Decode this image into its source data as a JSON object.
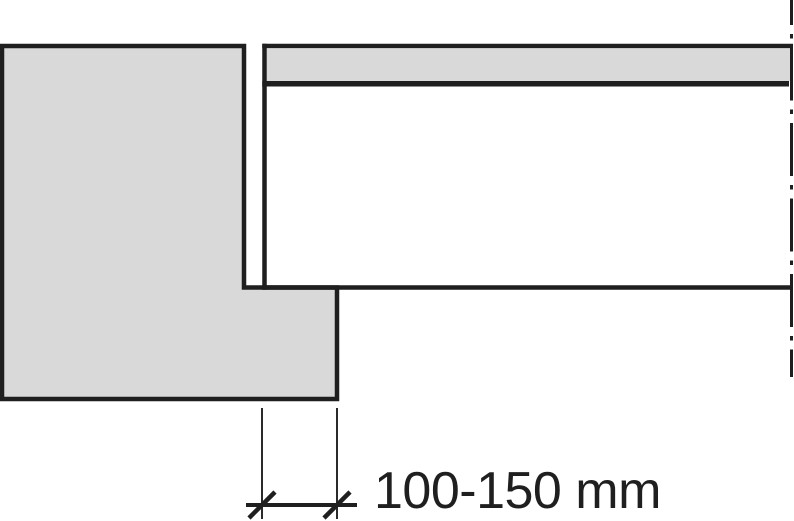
{
  "palette": {
    "line_color": "#1f1f1f",
    "concrete_gray": "#d9d9d9",
    "background": "#ffffff"
  },
  "drawing": {
    "kind": "construction-section-detail",
    "dimension": {
      "label": "100-150 mm"
    }
  }
}
